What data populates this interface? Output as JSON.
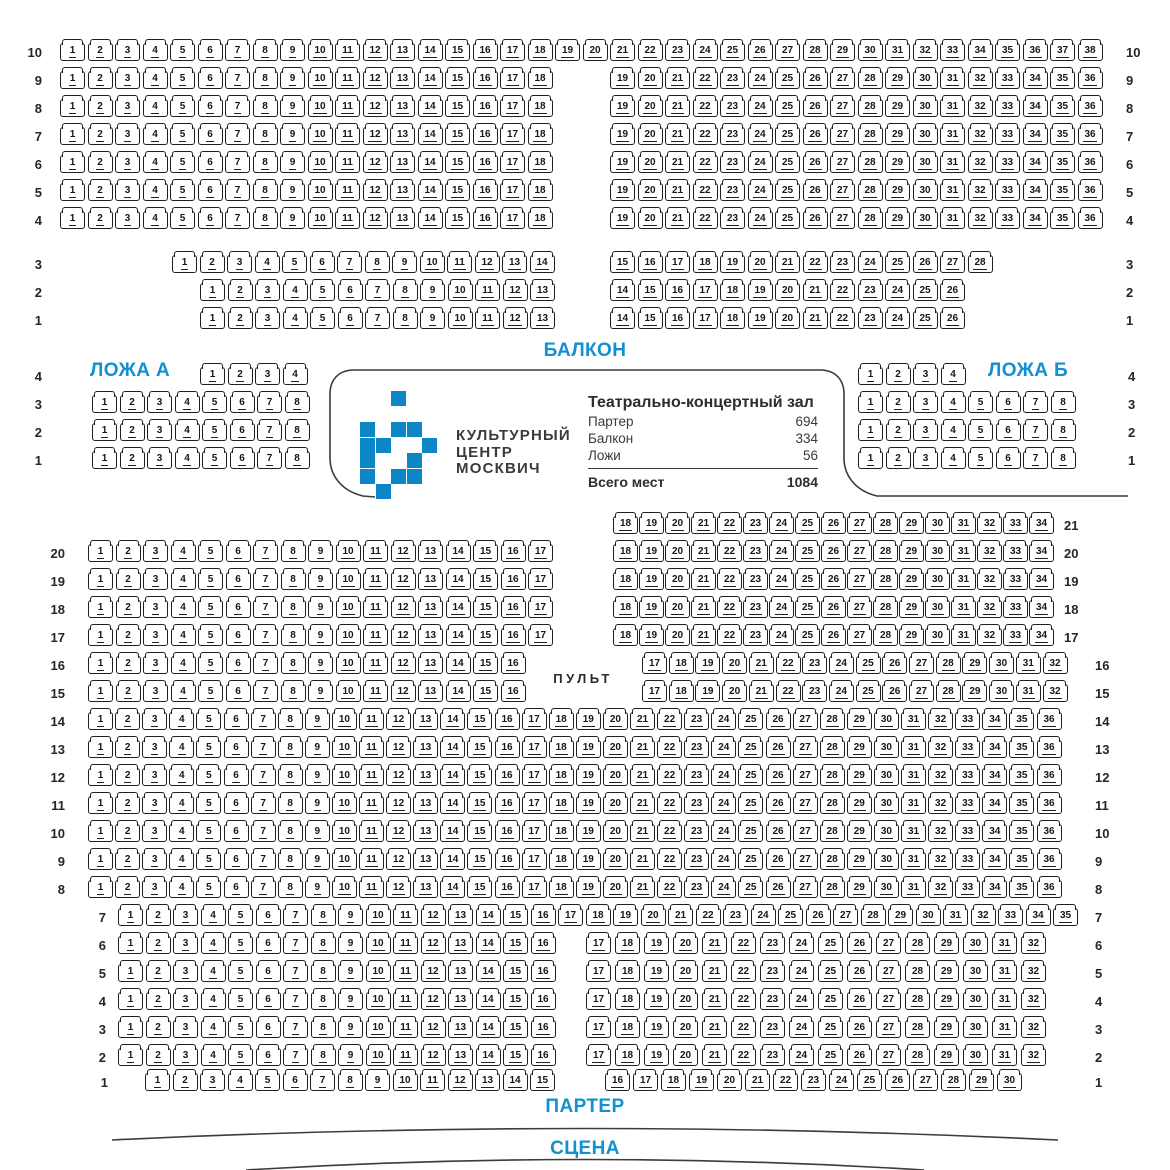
{
  "canvas": {
    "w": 1170,
    "h": 1170
  },
  "colors": {
    "accent": "#1290d2",
    "logo_blue": "#0c86c6",
    "seat_border": "#1f1f1f",
    "seat_shadow": "#bcbcbc",
    "line": "#3c3c3c"
  },
  "labels": {
    "balcony": "БАЛКОН",
    "parterre": "ПАРТЕР",
    "stage": "СЦЕНА",
    "pult": "ПУЛЬТ"
  },
  "info_panel": {
    "org_lines": [
      "КУЛЬТУРНЫЙ",
      "ЦЕНТР",
      "МОСКВИЧ"
    ],
    "hall_title": "Театрально-концертный зал",
    "stats": [
      {
        "label": "Партер",
        "value": "694"
      },
      {
        "label": "Балкон",
        "value": "334"
      },
      {
        "label": "Ложи",
        "value": "56"
      }
    ],
    "total_label": "Всего мест",
    "total_value": "1084",
    "logo_grid": [
      [
        2
      ],
      [],
      [
        0,
        2,
        3
      ],
      [
        0,
        1,
        4
      ],
      [
        0,
        3
      ],
      [
        0,
        2,
        3
      ],
      [
        1
      ]
    ],
    "logo_origin": {
      "x": 360,
      "y": 391,
      "cell": 15.5
    }
  },
  "seat_geometry": {
    "w": 25,
    "h": 18,
    "pitch": 27.5
  },
  "balcony": {
    "rows": [
      {
        "label": "10",
        "y": 43,
        "ll": 14,
        "rl": 1126,
        "blocks": [
          {
            "from": 1,
            "to": 38,
            "x": 60
          }
        ]
      },
      {
        "label": "9",
        "y": 71,
        "ll": 14,
        "rl": 1126,
        "blocks": [
          {
            "from": 1,
            "to": 18,
            "x": 60
          },
          {
            "from": 19,
            "to": 36,
            "x": 610
          }
        ]
      },
      {
        "label": "8",
        "y": 99,
        "ll": 14,
        "rl": 1126,
        "blocks": [
          {
            "from": 1,
            "to": 18,
            "x": 60
          },
          {
            "from": 19,
            "to": 36,
            "x": 610
          }
        ]
      },
      {
        "label": "7",
        "y": 127,
        "ll": 14,
        "rl": 1126,
        "blocks": [
          {
            "from": 1,
            "to": 18,
            "x": 60
          },
          {
            "from": 19,
            "to": 36,
            "x": 610
          }
        ]
      },
      {
        "label": "6",
        "y": 155,
        "ll": 14,
        "rl": 1126,
        "blocks": [
          {
            "from": 1,
            "to": 18,
            "x": 60
          },
          {
            "from": 19,
            "to": 36,
            "x": 610
          }
        ]
      },
      {
        "label": "5",
        "y": 183,
        "ll": 14,
        "rl": 1126,
        "blocks": [
          {
            "from": 1,
            "to": 18,
            "x": 60
          },
          {
            "from": 19,
            "to": 36,
            "x": 610
          }
        ]
      },
      {
        "label": "4",
        "y": 211,
        "ll": 14,
        "rl": 1126,
        "blocks": [
          {
            "from": 1,
            "to": 18,
            "x": 60
          },
          {
            "from": 19,
            "to": 36,
            "x": 610
          }
        ]
      },
      {
        "label": "3",
        "y": 255,
        "ll": 14,
        "rl": 1126,
        "blocks": [
          {
            "from": 1,
            "to": 14,
            "x": 172
          },
          {
            "from": 15,
            "to": 28,
            "x": 610
          }
        ]
      },
      {
        "label": "2",
        "y": 283,
        "ll": 14,
        "rl": 1126,
        "blocks": [
          {
            "from": 1,
            "to": 13,
            "x": 200
          },
          {
            "from": 14,
            "to": 26,
            "x": 610
          }
        ]
      },
      {
        "label": "1",
        "y": 311,
        "ll": 14,
        "rl": 1126,
        "blocks": [
          {
            "from": 1,
            "to": 13,
            "x": 200
          },
          {
            "from": 14,
            "to": 26,
            "x": 610
          }
        ]
      }
    ]
  },
  "lodges": {
    "a": {
      "title": "ЛОЖА А",
      "title_x": 90,
      "title_y": 360,
      "rows": [
        {
          "label": "4",
          "y": 367,
          "ll": 14,
          "blocks": [
            {
              "from": 1,
              "to": 4,
              "x": 200
            }
          ]
        },
        {
          "label": "3",
          "y": 395,
          "ll": 14,
          "blocks": [
            {
              "from": 1,
              "to": 8,
              "x": 92
            }
          ]
        },
        {
          "label": "2",
          "y": 423,
          "ll": 14,
          "blocks": [
            {
              "from": 1,
              "to": 8,
              "x": 92
            }
          ]
        },
        {
          "label": "1",
          "y": 451,
          "ll": 14,
          "blocks": [
            {
              "from": 1,
              "to": 8,
              "x": 92
            }
          ]
        }
      ]
    },
    "b": {
      "title": "ЛОЖА Б",
      "title_x": 988,
      "title_y": 360,
      "rows": [
        {
          "label": "4",
          "y": 367,
          "rl": 1128,
          "blocks": [
            {
              "from": 1,
              "to": 4,
              "x": 858
            }
          ]
        },
        {
          "label": "3",
          "y": 395,
          "rl": 1128,
          "blocks": [
            {
              "from": 1,
              "to": 8,
              "x": 858
            }
          ]
        },
        {
          "label": "2",
          "y": 423,
          "rl": 1128,
          "blocks": [
            {
              "from": 1,
              "to": 8,
              "x": 858
            }
          ]
        },
        {
          "label": "1",
          "y": 451,
          "rl": 1128,
          "blocks": [
            {
              "from": 1,
              "to": 8,
              "x": 858
            }
          ]
        }
      ]
    }
  },
  "parterre": {
    "rows": [
      {
        "label": "21",
        "y": 516,
        "rl": 1064,
        "blocks": [
          {
            "from": 18,
            "to": 34,
            "x": 613,
            "pitch": 26
          }
        ]
      },
      {
        "label": "20",
        "y": 544,
        "ll": 37,
        "rl": 1064,
        "blocks": [
          {
            "from": 1,
            "to": 17,
            "x": 88
          },
          {
            "from": 18,
            "to": 34,
            "x": 613,
            "pitch": 26
          }
        ]
      },
      {
        "label": "19",
        "y": 572,
        "ll": 37,
        "rl": 1064,
        "blocks": [
          {
            "from": 1,
            "to": 17,
            "x": 88
          },
          {
            "from": 18,
            "to": 34,
            "x": 613,
            "pitch": 26
          }
        ]
      },
      {
        "label": "18",
        "y": 600,
        "ll": 37,
        "rl": 1064,
        "blocks": [
          {
            "from": 1,
            "to": 17,
            "x": 88
          },
          {
            "from": 18,
            "to": 34,
            "x": 613,
            "pitch": 26
          }
        ]
      },
      {
        "label": "17",
        "y": 628,
        "ll": 37,
        "rl": 1064,
        "blocks": [
          {
            "from": 1,
            "to": 17,
            "x": 88
          },
          {
            "from": 18,
            "to": 34,
            "x": 613,
            "pitch": 26
          }
        ]
      },
      {
        "label": "16",
        "y": 656,
        "ll": 37,
        "rl": 1095,
        "blocks": [
          {
            "from": 1,
            "to": 16,
            "x": 88
          },
          {
            "from": 17,
            "to": 32,
            "x": 642,
            "pitch": 26.7
          }
        ]
      },
      {
        "label": "15",
        "y": 684,
        "ll": 37,
        "rl": 1095,
        "blocks": [
          {
            "from": 1,
            "to": 16,
            "x": 88
          },
          {
            "from": 17,
            "to": 32,
            "x": 642,
            "pitch": 26.7
          }
        ]
      },
      {
        "label": "14",
        "y": 712,
        "ll": 37,
        "rl": 1095,
        "blocks": [
          {
            "from": 1,
            "to": 36,
            "x": 88,
            "pitch": 27.1
          }
        ]
      },
      {
        "label": "13",
        "y": 740,
        "ll": 37,
        "rl": 1095,
        "blocks": [
          {
            "from": 1,
            "to": 36,
            "x": 88,
            "pitch": 27.1
          }
        ]
      },
      {
        "label": "12",
        "y": 768,
        "ll": 37,
        "rl": 1095,
        "blocks": [
          {
            "from": 1,
            "to": 36,
            "x": 88,
            "pitch": 27.1
          }
        ]
      },
      {
        "label": "11",
        "y": 796,
        "ll": 37,
        "rl": 1095,
        "blocks": [
          {
            "from": 1,
            "to": 36,
            "x": 88,
            "pitch": 27.1
          }
        ]
      },
      {
        "label": "10",
        "y": 824,
        "ll": 37,
        "rl": 1095,
        "blocks": [
          {
            "from": 1,
            "to": 36,
            "x": 88,
            "pitch": 27.1
          }
        ]
      },
      {
        "label": "9",
        "y": 852,
        "ll": 37,
        "rl": 1095,
        "blocks": [
          {
            "from": 1,
            "to": 36,
            "x": 88,
            "pitch": 27.1
          }
        ]
      },
      {
        "label": "8",
        "y": 880,
        "ll": 37,
        "rl": 1095,
        "blocks": [
          {
            "from": 1,
            "to": 36,
            "x": 88,
            "pitch": 27.1
          }
        ]
      },
      {
        "label": "7",
        "y": 908,
        "ll": 78,
        "rl": 1095,
        "blocks": [
          {
            "from": 1,
            "to": 35,
            "x": 118
          }
        ]
      },
      {
        "label": "6",
        "y": 936,
        "ll": 78,
        "rl": 1095,
        "blocks": [
          {
            "from": 1,
            "to": 16,
            "x": 118
          },
          {
            "from": 17,
            "to": 32,
            "x": 586,
            "pitch": 29
          }
        ]
      },
      {
        "label": "5",
        "y": 964,
        "ll": 78,
        "rl": 1095,
        "blocks": [
          {
            "from": 1,
            "to": 16,
            "x": 118
          },
          {
            "from": 17,
            "to": 32,
            "x": 586,
            "pitch": 29
          }
        ]
      },
      {
        "label": "4",
        "y": 992,
        "ll": 78,
        "rl": 1095,
        "blocks": [
          {
            "from": 1,
            "to": 16,
            "x": 118
          },
          {
            "from": 17,
            "to": 32,
            "x": 586,
            "pitch": 29
          }
        ]
      },
      {
        "label": "3",
        "y": 1020,
        "ll": 78,
        "rl": 1095,
        "blocks": [
          {
            "from": 1,
            "to": 16,
            "x": 118
          },
          {
            "from": 17,
            "to": 32,
            "x": 586,
            "pitch": 29
          }
        ]
      },
      {
        "label": "2",
        "y": 1048,
        "ll": 78,
        "rl": 1095,
        "blocks": [
          {
            "from": 1,
            "to": 16,
            "x": 118
          },
          {
            "from": 17,
            "to": 32,
            "x": 586,
            "pitch": 29
          }
        ]
      },
      {
        "label": "1",
        "y": 1073,
        "ll": 80,
        "rl": 1095,
        "blocks": [
          {
            "from": 1,
            "to": 15,
            "x": 145
          },
          {
            "from": 16,
            "to": 30,
            "x": 605,
            "pitch": 28
          }
        ]
      }
    ]
  },
  "section_label_positions": {
    "balcony": {
      "x": 585,
      "y": 340
    },
    "parterre": {
      "x": 585,
      "y": 1096
    },
    "stage": {
      "x": 585,
      "y": 1138
    },
    "pult": {
      "x": 583,
      "y": 671
    }
  },
  "decor": {
    "panel_paths": [
      "M 352 370 L 822 370",
      "M 352 370 C 338 371 330 380 330 394 L 330 458 C 330 476 342 491 363 496 L 375 497",
      "M 822 370 C 836 371 844 380 844 394 L 844 458 C 844 476 856 491 877 496 L 1128 496"
    ],
    "stage_arcs": [
      "M 112 1140 Q 585 1117 1058 1140",
      "M 246 1170 Q 585 1149 924 1170"
    ]
  }
}
